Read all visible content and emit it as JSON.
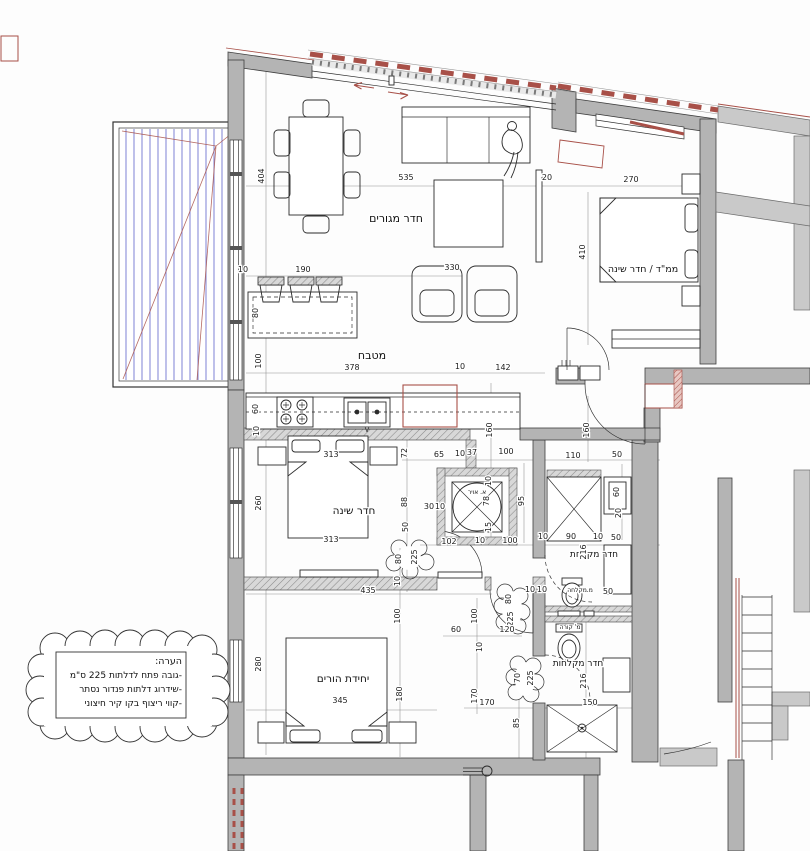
{
  "colors": {
    "wall": "#b4b4b4",
    "wall_light": "#c9c9c9",
    "accent_red": "#a85048",
    "deck_blue": "#8a8ed8",
    "ink": "#1c1c1c"
  },
  "plan": {
    "rooms": [
      {
        "name": "room-label-living-room",
        "label": "חדר מגורים",
        "x": 396,
        "y": 222,
        "s": 11
      },
      {
        "name": "room-label-kitchen",
        "label": "מטבח",
        "x": 372,
        "y": 359,
        "s": 11
      },
      {
        "name": "room-label-safe-room-bedroom",
        "label": "ממ\"ד / חדר שינה",
        "x": 643,
        "y": 272,
        "s": 9.5
      },
      {
        "name": "room-label-bedroom",
        "label": "חדר שינה",
        "x": 354,
        "y": 514,
        "s": 10.5
      },
      {
        "name": "room-label-shower-room",
        "label": "חדר מקלחת",
        "x": 594,
        "y": 557,
        "s": 9
      },
      {
        "name": "room-label-shower-room-2",
        "label": "חדר מקלחות",
        "x": 578,
        "y": 666,
        "s": 9
      },
      {
        "name": "room-label-parents-unit",
        "label": "יחידת הורים",
        "x": 343,
        "y": 682,
        "s": 10.5
      },
      {
        "name": "label-air-shaft",
        "label": "א. אויר",
        "x": 477,
        "y": 494,
        "s": 6
      },
      {
        "name": "label-shower-niche",
        "label": "מ.מקלחה",
        "x": 580,
        "y": 592,
        "s": 6
      },
      {
        "name": "label-beam",
        "label": "מ' קורה",
        "x": 570,
        "y": 629,
        "s": 6
      }
    ],
    "dims": [
      [
        "404",
        264,
        176,
        1
      ],
      [
        "535",
        406,
        180,
        0
      ],
      [
        "20",
        547,
        180,
        0
      ],
      [
        "270",
        631,
        182,
        0
      ],
      [
        "410",
        585,
        252,
        1
      ],
      [
        "10",
        243,
        272,
        0
      ],
      [
        "190",
        303,
        272,
        0
      ],
      [
        "330",
        452,
        270,
        0
      ],
      [
        "80",
        258,
        313,
        1
      ],
      [
        "100",
        261,
        361,
        1
      ],
      [
        "378",
        352,
        370,
        0
      ],
      [
        "10",
        460,
        369,
        0
      ],
      [
        "142",
        503,
        370,
        0
      ],
      [
        "60",
        258,
        409,
        1
      ],
      [
        "10",
        259,
        431,
        1
      ],
      [
        "160",
        492,
        430,
        1
      ],
      [
        "160",
        589,
        430,
        1
      ],
      [
        "313",
        331,
        457,
        0
      ],
      [
        "72",
        407,
        453,
        1
      ],
      [
        "65",
        439,
        457,
        0
      ],
      [
        "10",
        460,
        456,
        0
      ],
      [
        "37",
        472,
        455,
        0
      ],
      [
        "100",
        506,
        454,
        0
      ],
      [
        "110",
        573,
        458,
        0
      ],
      [
        "50",
        617,
        457,
        0
      ],
      [
        "260",
        261,
        503,
        1
      ],
      [
        "88",
        407,
        502,
        1
      ],
      [
        "30",
        429,
        509,
        0
      ],
      [
        "10",
        440,
        509,
        0
      ],
      [
        "78",
        489,
        501,
        1
      ],
      [
        "10",
        491,
        481,
        1
      ],
      [
        "95",
        524,
        501,
        1
      ],
      [
        "60",
        619,
        492,
        1
      ],
      [
        "20",
        621,
        513,
        1
      ],
      [
        "50",
        408,
        527,
        1
      ],
      [
        "15",
        491,
        527,
        1
      ],
      [
        "313",
        331,
        542,
        0
      ],
      [
        "102",
        449,
        544,
        0
      ],
      [
        "10",
        480,
        543,
        0
      ],
      [
        "100",
        510,
        543,
        0
      ],
      [
        "10",
        543,
        539,
        0
      ],
      [
        "90",
        571,
        539,
        0
      ],
      [
        "10",
        598,
        539,
        0
      ],
      [
        "50",
        616,
        540,
        0
      ],
      [
        "216",
        586,
        552,
        1
      ],
      [
        "80",
        401,
        559,
        1
      ],
      [
        "225",
        417,
        557,
        1
      ],
      [
        "10",
        400,
        581,
        1
      ],
      [
        "435",
        368,
        593,
        0
      ],
      [
        "10",
        530,
        592,
        0
      ],
      [
        "10",
        542,
        592,
        0
      ],
      [
        "50",
        608,
        594,
        0
      ],
      [
        "80",
        511,
        599,
        1
      ],
      [
        "225",
        513,
        619,
        1
      ],
      [
        "100",
        400,
        616,
        1
      ],
      [
        "100",
        477,
        616,
        1
      ],
      [
        "60",
        456,
        632,
        0
      ],
      [
        "120",
        507,
        632,
        0
      ],
      [
        "10",
        482,
        647,
        1
      ],
      [
        "280",
        261,
        664,
        1
      ],
      [
        "70",
        520,
        678,
        1
      ],
      [
        "225",
        533,
        678,
        1
      ],
      [
        "216",
        586,
        681,
        1
      ],
      [
        "180",
        402,
        694,
        1
      ],
      [
        "170",
        477,
        696,
        1
      ],
      [
        "170",
        487,
        705,
        0
      ],
      [
        "345",
        340,
        703,
        0
      ],
      [
        "150",
        590,
        705,
        0
      ],
      [
        "85",
        519,
        723,
        1
      ]
    ],
    "note": {
      "title": "הערה:",
      "lines": [
        "-גובה פתח לדלתות 225 ס\"מ",
        "-שידרוג דלתות פנדור נסתר",
        "-קווי ריצוף בקו קיר חיצוני"
      ]
    }
  }
}
